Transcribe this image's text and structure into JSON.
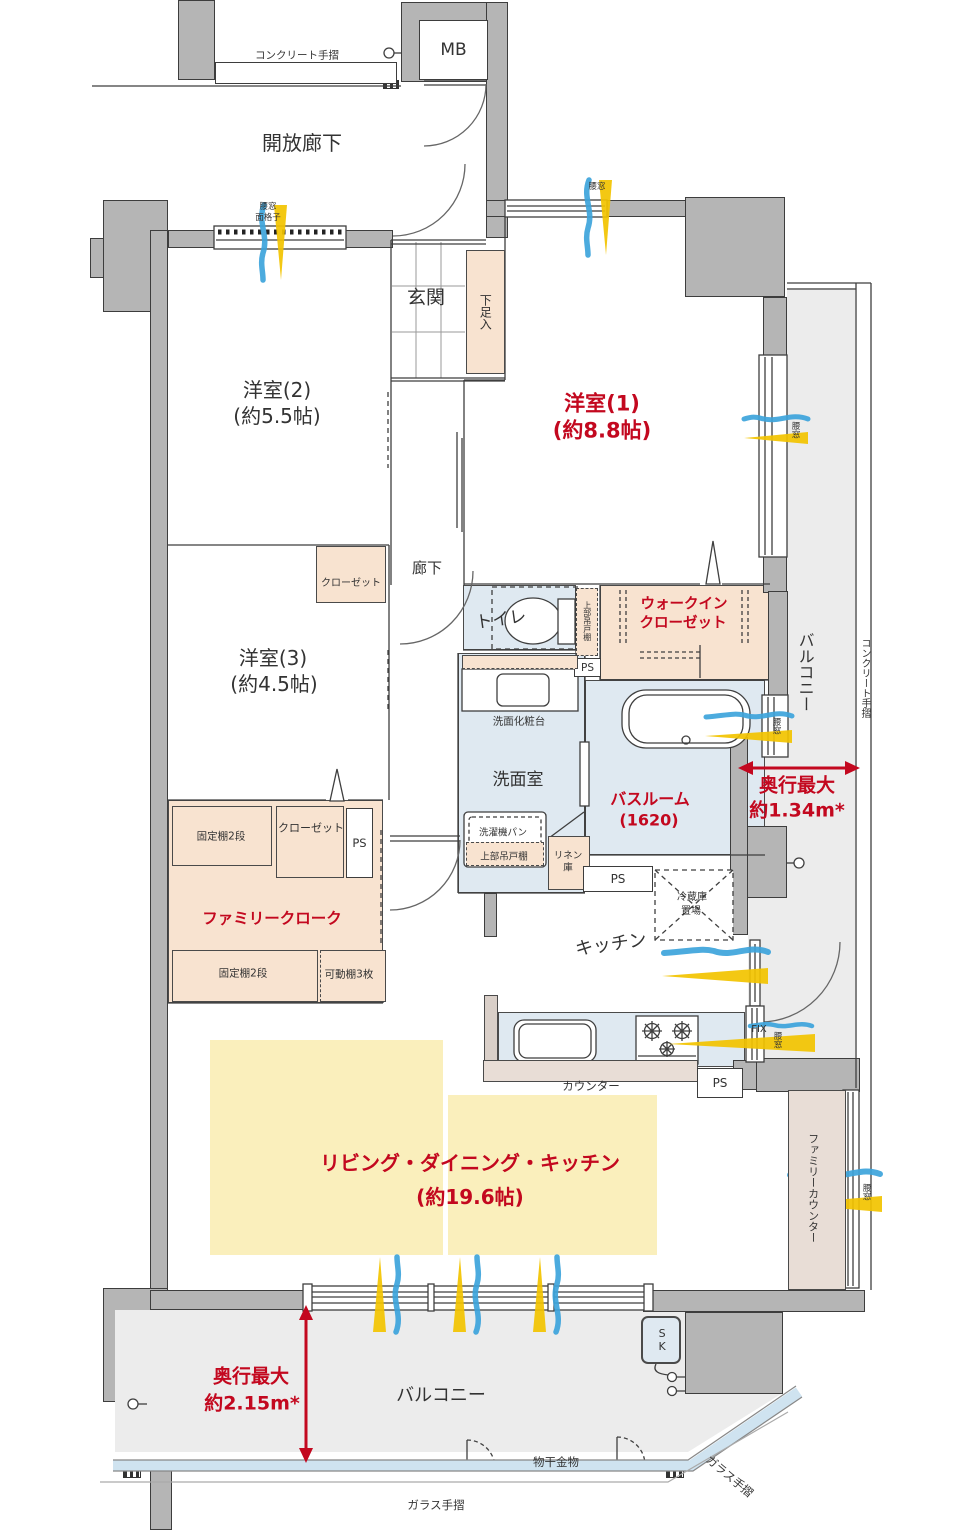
{
  "colors": {
    "wall_gray": "#b5b5b5",
    "outline": "#3d3d3d",
    "room_peach": "#f8e3d0",
    "room_blue": "#dfe9f1",
    "ldk_yellow": "#faefbc",
    "balcony_gray": "#ececec",
    "counter_pink": "#e8ddd6",
    "glass_blue": "#cfe3f0",
    "accent_red": "#c3081f",
    "wind_blue": "#3da4dc",
    "wind_yellow": "#f3c400"
  },
  "header": {
    "mb": "MB",
    "concrete_rail": "コンクリート手摺",
    "open_corridor": "開放廊下"
  },
  "rooms": {
    "western2": {
      "name": "洋室(2)",
      "size": "(約5.5帖)"
    },
    "western1": {
      "name": "洋室(1)",
      "size": "(約8.8帖)"
    },
    "western3": {
      "name": "洋室(3)",
      "size": "(約4.5帖)"
    },
    "ldk": {
      "name": "リビング・ダイニング・キッチン",
      "size": "(約19.6帖)"
    },
    "bathroom": {
      "name": "バスルーム",
      "size": "(1620)"
    },
    "washroom": {
      "name": "洗面室"
    },
    "toilet": {
      "name": "トイレ"
    },
    "entrance": {
      "name": "玄関"
    },
    "corridor": {
      "name": "廊下"
    },
    "kitchen": {
      "name": "キッチン"
    },
    "wic": {
      "line1": "ウォークイン",
      "line2": "クローゼット"
    },
    "family_cloak": {
      "name": "ファミリークローク"
    }
  },
  "storage": {
    "shoe_cabinet": "下足入",
    "closet": "クローゼット",
    "upper_hanging_cabinet": "上部吊戸棚",
    "fixed_shelf_2": "固定棚2段",
    "movable_shelf_3": "可動棚3枚",
    "linen_line1": "リネン",
    "linen_line2": "庫",
    "washer_pan": "洗濯機パン",
    "vanity": "洗面化粧台",
    "fridge_line1": "冷蔵庫",
    "fridge_line2": "置場",
    "counter": "カウンター",
    "family_counter": "ファミリーカウンター"
  },
  "windows": {
    "koshimado": "腰窓",
    "grille_line1": "腰窓",
    "grille_line2": "面格子",
    "fix": "FIX"
  },
  "balcony": {
    "right": "バルコニー",
    "bottom": "バルコニー",
    "concrete_rail": "コンクリート手摺",
    "glass_rail": "ガラス手摺",
    "laundry_fitting": "物干金物",
    "sk": "SK",
    "depth_right": {
      "label": "奥行最大",
      "value": "約1.34m*"
    },
    "depth_bottom": {
      "label": "奥行最大",
      "value": "約2.15m*"
    }
  },
  "utility": {
    "ps": "PS"
  }
}
